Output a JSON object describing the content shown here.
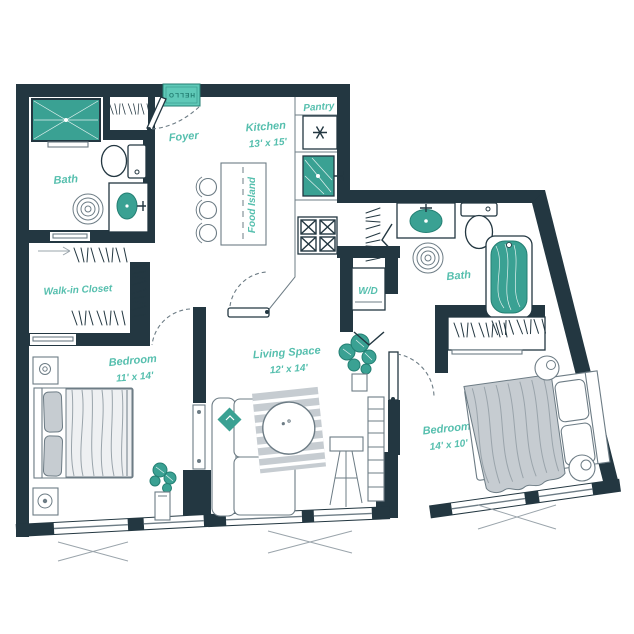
{
  "colors": {
    "wall": "#233741",
    "accent": "#3aa193",
    "accent-dark": "#247f73",
    "accent-light": "#5fc9b8",
    "label": "#56bfae",
    "line": "#6d7c85",
    "line2": "#9aa4ab",
    "furn": "#c6ccd1"
  },
  "plan": {
    "entry_mat": "HELLO",
    "foyer": {
      "name": "Foyer"
    },
    "kitchen": {
      "name": "Kitchen",
      "dims": "13' x 15'"
    },
    "pantry": {
      "name": "Pantry"
    },
    "island": {
      "name": "Food Island"
    },
    "bath_1": {
      "name": "Bath"
    },
    "walk_in_closet": {
      "name": "Walk-in Closet"
    },
    "bedroom_1": {
      "name": "Bedroom",
      "dims": "11' x 14'"
    },
    "living_space": {
      "name": "Living Space",
      "dims": "12' x 14'"
    },
    "washer_dryer": {
      "name": "W/D"
    },
    "bath_2": {
      "name": "Bath"
    },
    "bedroom_2": {
      "name": "Bedroom",
      "dims": "14' x 10'"
    }
  }
}
